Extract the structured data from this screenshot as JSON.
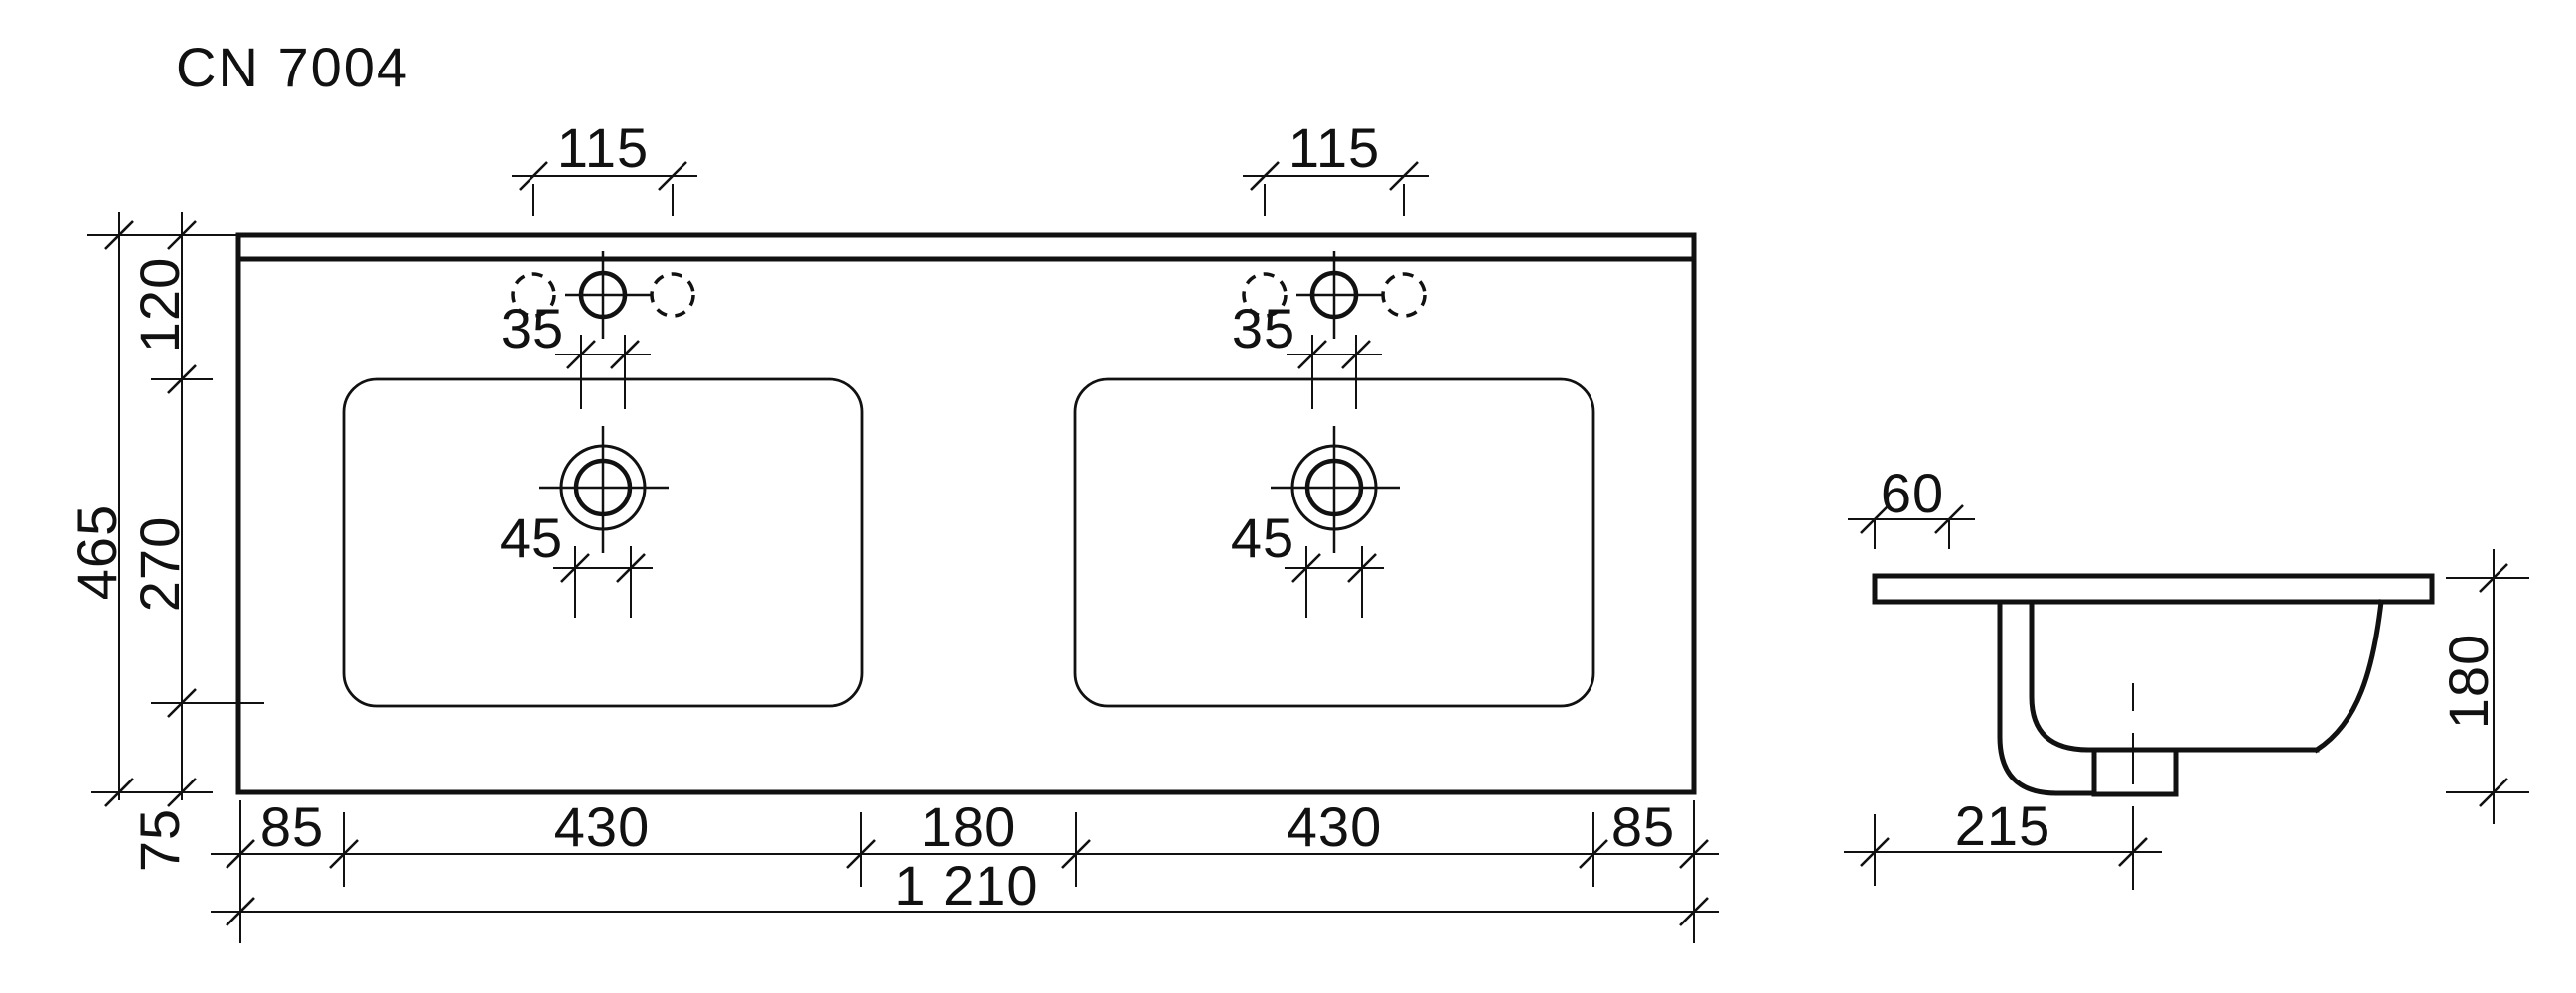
{
  "title": "CN 7004",
  "plan_view": {
    "faucet_hole_spacing_left": "115",
    "faucet_hole_spacing_right": "115",
    "edge_to_basin_top": "120",
    "basin_depth": "270",
    "overall_depth": "465",
    "basin_to_front_edge": "75",
    "faucet_hole_diameter_left": "35",
    "faucet_hole_diameter_right": "35",
    "drain_diameter_left": "45",
    "drain_diameter_right": "45",
    "side_margin_left": "85",
    "basin_width_left": "430",
    "basin_gap": "180",
    "basin_width_right": "430",
    "side_margin_right": "85",
    "overall_width": "1 210"
  },
  "side_view": {
    "back_edge_offset": "60",
    "overall_height": "180",
    "drain_offset_from_back": "215"
  }
}
